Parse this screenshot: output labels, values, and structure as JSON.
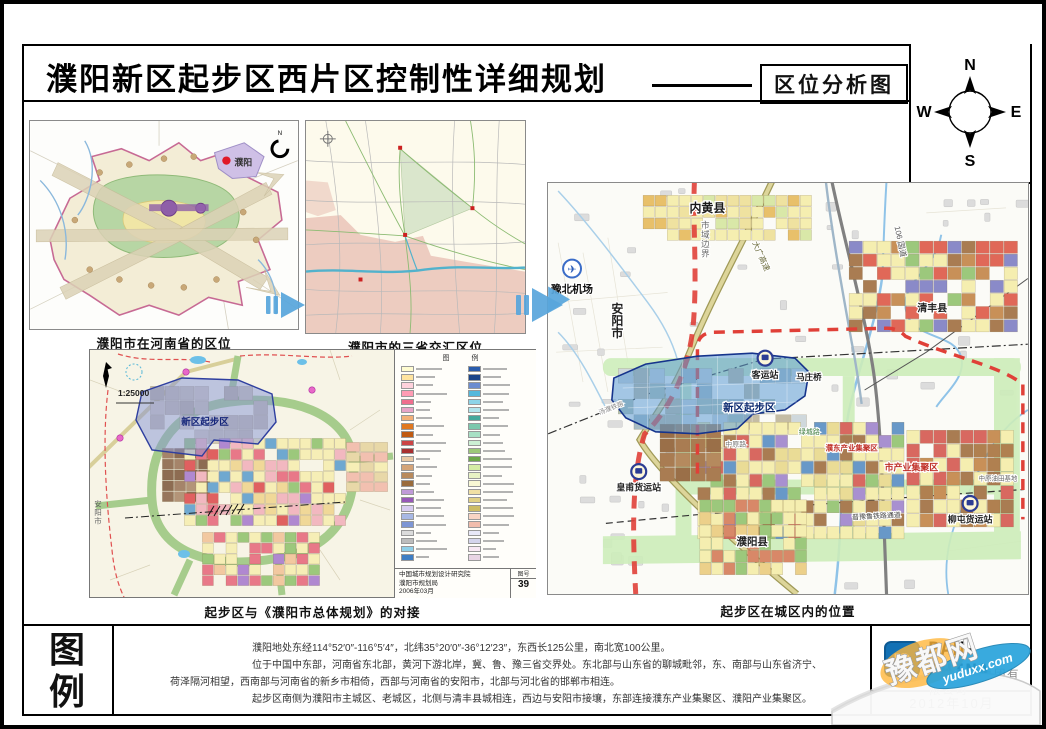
{
  "header": {
    "title": "濮阳新区起步区西片区控制性详细规划",
    "subtitle": "区位分析图"
  },
  "compass": {
    "n": "N",
    "e": "E",
    "s": "S",
    "w": "W"
  },
  "maps": {
    "henan": {
      "caption": "濮阳市在河南省的区位",
      "city_dot_label": "濮阳"
    },
    "tri_province": {
      "caption": "濮阳市的三省交汇区位"
    },
    "master_plan": {
      "caption": "起步区与《濮阳市总体规划》的对接",
      "scale": "1:25000",
      "overlay_label": "新区起步区",
      "left_label": "安阳市",
      "legend_header": "图 例",
      "attribution_line1": "中国城市规划设计研究院",
      "attribution_line2": "濮阳市规划局",
      "attribution_line3": "2006年03月",
      "sheet_label": "图号",
      "sheet_number": "39",
      "legend_left": [
        "#fffcd0",
        "#ffe4a0",
        "#ffd2dc",
        "#ff9cb4",
        "#f06e8e",
        "#e8a4c8",
        "#f2b078",
        "#e07820",
        "#c05a10",
        "#cc4444",
        "#a83030",
        "#e8c8a4",
        "#d4a478",
        "#b88a5c",
        "#9a6c3c",
        "#c09ad8",
        "#9858b8",
        "#d8ccf0",
        "#a8b8e4",
        "#7e96d4",
        "#dcdcdc",
        "#bcbcbc",
        "#8fcfe8",
        "#3f7ec4"
      ],
      "legend_right": [
        "#2a5cac",
        "#1a4488",
        "#6c8cd0",
        "#54b8dc",
        "#8cd4e8",
        "#b0e4ec",
        "#44a89c",
        "#7cc8ac",
        "#a8e0c4",
        "#ccf0d4",
        "#9cc878",
        "#6ca848",
        "#d4eca4",
        "#e8f2c4",
        "#f8f8d4",
        "#f0e0a4",
        "#e0d084",
        "#ccbc64",
        "#f8d4c4",
        "#f0bcac",
        "#e8e8f8",
        "#d4d4ec",
        "#f8e8f4",
        "#e8d4e4"
      ]
    },
    "city_area": {
      "caption": "起步区在城区内的位置",
      "labels": {
        "neihuang": "内黄县",
        "boundary": "市域边界",
        "daguang": "大广高速",
        "g106": "106 国道",
        "airport": "豫北机场",
        "anyang": "安阳市",
        "qingfeng": "清丰县",
        "keyunzhan": "客运站",
        "mazhuangqiao": "马庄桥",
        "overlay": "新区起步区",
        "zhongyuanlu": "中原路",
        "lvchenglu": "绿城路",
        "pudong": "濮东产业集聚区",
        "shichanye": "市产业集聚区",
        "huangfu": "皇甫货运站",
        "liutun": "柳屯货运站",
        "youtian": "中原油田基地",
        "jinyulu": "晋豫鲁铁路通道",
        "puyangxian": "濮阳县",
        "tangpu": "汤濮铁路"
      }
    }
  },
  "footer": {
    "legend_char_1": "图",
    "legend_char_2": "例",
    "notes": [
      "濮阳地处东经114°52′0″-116°5′4″，北纬35°20′0″-36°12′23″，东西长125公里，南北宽100公里。",
      "位于中国中东部，河南省东北部，黄河下游北岸，冀、鲁、豫三省交界处。东北部与山东省的聊城毗邻，东、南部与山东省济宁、",
      "荷泽隔河相望，西南部与河南省的新乡市相倚，西部与河南省的安阳市，北部与河北省的邯郸市相连。",
      "起步区南侧为濮阳市主城区、老城区，北侧与清丰县城相连，西边与安阳市接壤，东部连接濮东产业集聚区、濮阳产业集聚区。"
    ],
    "company_en": "PAN-CHINA",
    "company_cn": "泛华建设集团有限公司",
    "date": "2012年10月"
  },
  "watermark": {
    "name": "豫都网",
    "url": "yuduxx.com"
  },
  "colors": {
    "overlay_blue": "#5b9bd5",
    "boundary_red": "#e04038",
    "green_corridor": "#cdedba",
    "water_blue": "#8fc3e8",
    "expressway_khaki": "#ddd59a",
    "connector_blue": "#58a6dc",
    "logo_blue": "#1271b5"
  }
}
